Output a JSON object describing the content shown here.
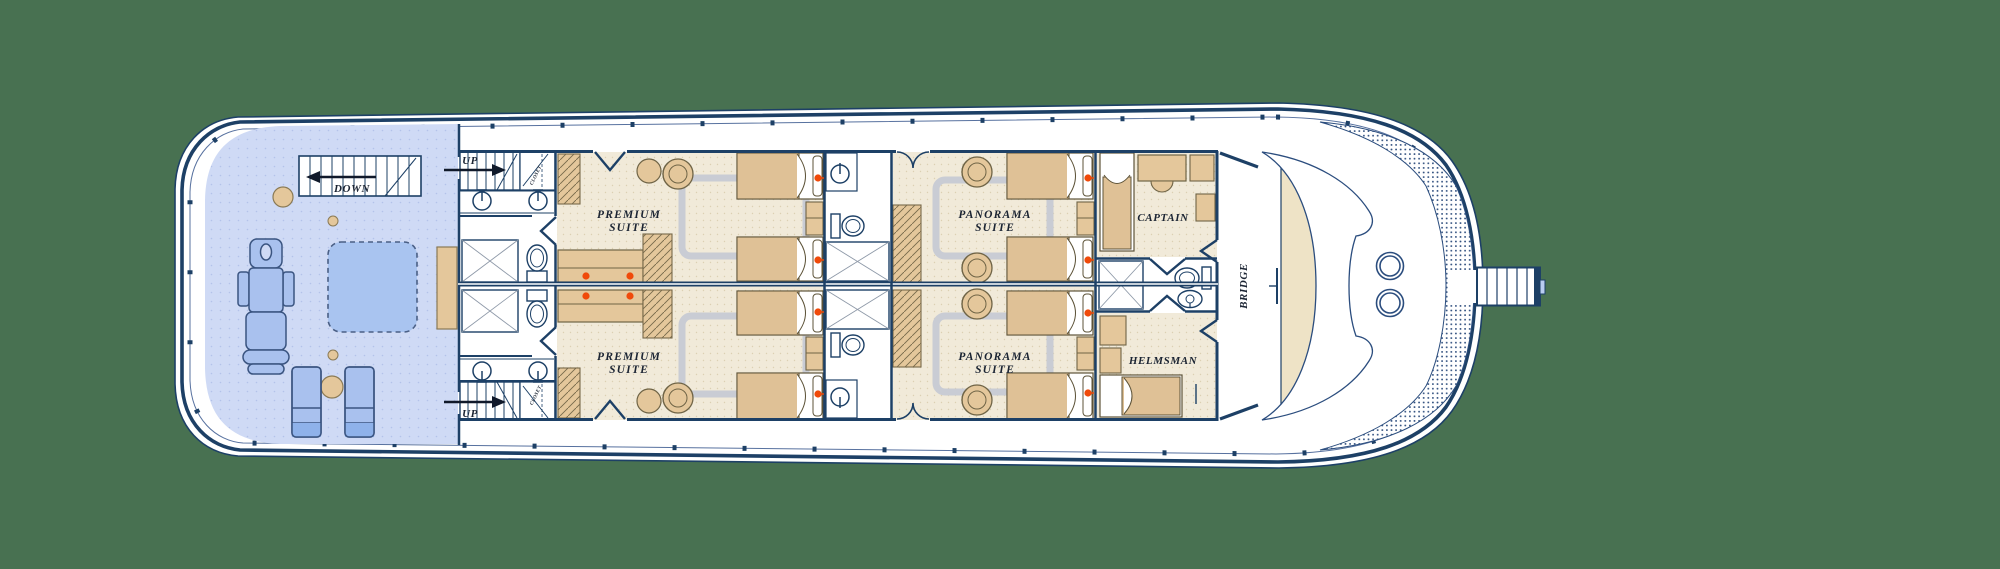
{
  "plan_type": "yacht deck floor plan",
  "palette": {
    "background": "#487151",
    "hull_fill": "#ffffff",
    "wall_navy": "#1d4066",
    "line_blue": "#2b4d7e",
    "aft_deck_blue": "#cfdaf5",
    "deck_furniture_blue": "#a9c1ee",
    "suite_floor_cream": "#f1ead9",
    "furniture_tan": "#e4c79b",
    "bed_blanket_tan": "#dfc196",
    "rug_gray": "#c9ccd4",
    "accent_dot_red": "#f04a0a",
    "console_tan": "#eee3c6"
  },
  "labels": {
    "down": "DOWN",
    "up_top": "UP",
    "up_bottom": "UP",
    "closet_top": "CLOSET",
    "closet_bottom": "CLOSET",
    "premium_top": {
      "line1": "PREMIUM",
      "line2": "SUITE"
    },
    "premium_bottom": {
      "line1": "PREMIUM",
      "line2": "SUITE"
    },
    "panorama_top": {
      "line1": "PANORAMA",
      "line2": "SUITE"
    },
    "panorama_bottom": {
      "line1": "PANORAMA",
      "line2": "SUITE"
    },
    "captain": "CAPTAIN",
    "helmsman": "HELMSMAN",
    "bridge": "BRIDGE"
  },
  "rooms": [
    "Premium Suite (port)",
    "Premium Suite (starboard)",
    "Panorama Suite (port)",
    "Panorama Suite (starboard)",
    "Captain",
    "Helmsman",
    "Bridge",
    "Aft open deck with stairs down, spa bed, massage chair and sun loungers"
  ]
}
